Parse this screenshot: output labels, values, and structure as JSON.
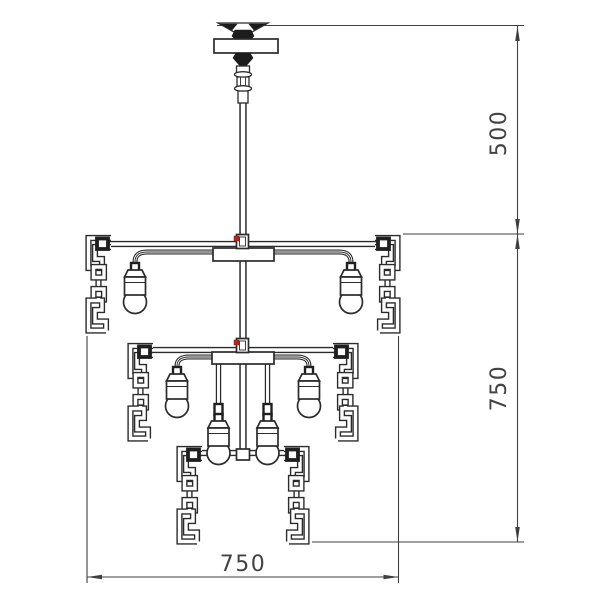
{
  "drawing": {
    "title": "chandelier-technical-drawing",
    "colors": {
      "background": "#ffffff",
      "line": "#2b2b2b",
      "dimension": "#3f3f3f",
      "accent_red": "#b02a25"
    },
    "dimensions": {
      "suspension_height": "500",
      "fixture_height": "750",
      "fixture_width": "750"
    },
    "content": {
      "bulbs_visible": "6",
      "arm_tiers": "2"
    }
  }
}
